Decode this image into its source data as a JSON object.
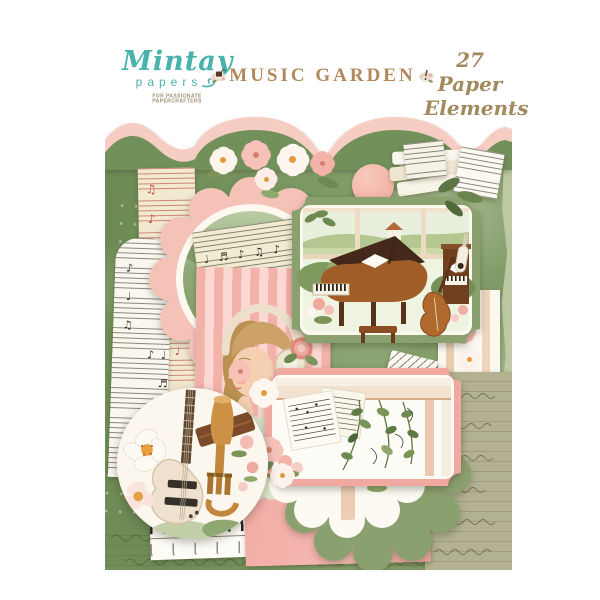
{
  "page": {
    "background": "#ffffff"
  },
  "header": {
    "brand": {
      "name": "Mintay",
      "word2": "papers",
      "tagline": "FOR PASSIONATE PAPERCRAFTERS",
      "color": "#49b2aa"
    },
    "title": {
      "text": "MUSIC GARDEN",
      "color": "#b2875a"
    },
    "badge": {
      "line1": "27 Paper",
      "line2": "Elements",
      "color": "#a18a5e"
    }
  },
  "collage": {
    "palette": {
      "moss_green": "#71905a",
      "sage_green": "#8ba06f",
      "blush_pink": "#f6cdc3",
      "salmon_pink": "#f0a8a1",
      "stripe_pink": "#f6bdb4",
      "cream_sheet": "#f2ebd1",
      "olive_paper": "#b2b192",
      "piano_brown": "#9c5a28"
    },
    "elements": [
      "pink-scalloped-border",
      "moss-green-sheet",
      "red-staff-sheet-music",
      "black-staff-sheet-music",
      "pink-scalloped-circle",
      "cream-sheet-music",
      "wild-rose-flowers",
      "eucalyptus-sprigs",
      "book-stack",
      "grand-piano-frame",
      "girl-with-headphones",
      "music-chevron-piece",
      "window-with-flowers",
      "pink-window-frame",
      "ivy-leaves",
      "green-scalloped-circle",
      "guitar-and-trumpet-circle",
      "pink-paper",
      "striped-paper",
      "keyboard-strip",
      "olive-script-paper"
    ],
    "glyphs": {
      "notes_a": "♪ ♩ ♫",
      "notes_b": "♬ ♪ ♩",
      "notes_c": "♫ ♪",
      "notes_d": "♩ ♬ ♪ ♫ ♪"
    }
  }
}
